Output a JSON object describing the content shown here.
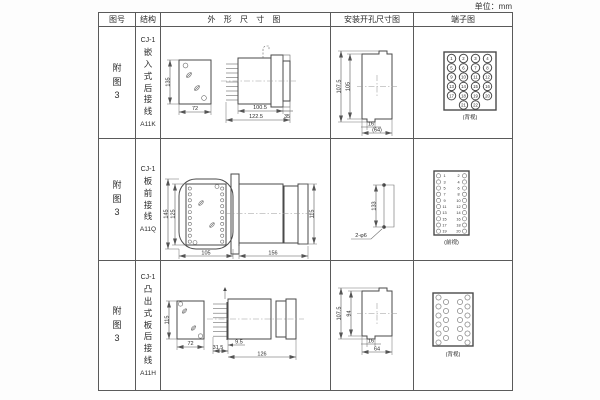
{
  "unit_label": "单位：mm",
  "headers": {
    "fig_no": "图号",
    "structure": "结构",
    "outline": "外 形 尺 寸 图",
    "mounting": "安装开孔尺寸图",
    "terminal": "端子图"
  },
  "rows": [
    {
      "fig_no": "附图3",
      "structure": {
        "model": "CJ-1",
        "desc": "嵌入式后接线",
        "code": "A11K"
      },
      "outline_dims": {
        "front_height": "135",
        "front_width": "72",
        "depth_body": "100.5",
        "depth_total": "122.5",
        "flange": "35"
      },
      "mounting_dims": {
        "outer_height": "107.5",
        "inner_height": "105",
        "notch_width": "16",
        "overall_width": "(64)"
      },
      "terminal": {
        "caption": "(背视)",
        "grid": [
          [
            1,
            2,
            3,
            4
          ],
          [
            5,
            6,
            7,
            8
          ],
          [
            9,
            10,
            11,
            12
          ],
          [
            13,
            14,
            15,
            16
          ],
          [
            17,
            18,
            19,
            20
          ],
          [
            21,
            22
          ]
        ]
      }
    },
    {
      "fig_no": "附图3",
      "structure": {
        "model": "CJ-1",
        "desc": "板前接线",
        "code": "A11Q"
      },
      "outline_dims": {
        "front_height": "145",
        "front_inner_height": "125",
        "front_width": "105",
        "depth_total": "156",
        "side_height": "115"
      },
      "mounting_dims": {
        "hole_spacing": "133",
        "hole_label": "2-φ6"
      },
      "terminal": {
        "caption": "(前视)",
        "pairs": [
          [
            1,
            2
          ],
          [
            3,
            4
          ],
          [
            5,
            6
          ],
          [
            7,
            8
          ],
          [
            9,
            10
          ],
          [
            11,
            12
          ],
          [
            13,
            14
          ],
          [
            15,
            16
          ],
          [
            17,
            18
          ],
          [
            19,
            20
          ]
        ]
      }
    },
    {
      "fig_no": "附图3",
      "structure": {
        "model": "CJ-1",
        "desc": "凸出式板后接线",
        "code": "A11H"
      },
      "outline_dims": {
        "front_height": "115",
        "front_width": "72",
        "pin_depth": "31.5",
        "step": "9.5",
        "depth_body": "126"
      },
      "mounting_dims": {
        "outer_height": "107.5",
        "inner_height": "94",
        "notch_width": "16",
        "overall_width": "64"
      },
      "terminal": {
        "caption": "(背视)",
        "pattern": [
          6,
          5,
          5,
          6
        ]
      }
    }
  ]
}
